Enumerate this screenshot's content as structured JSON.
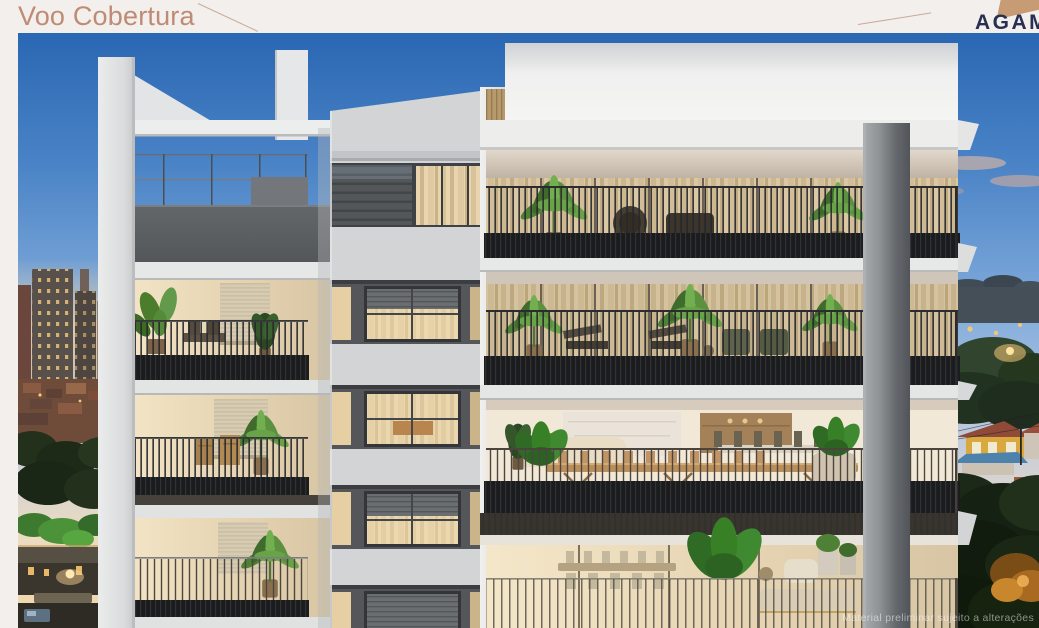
{
  "page": {
    "background_color": "#f2efec"
  },
  "header": {
    "title": "Voo Cobertura",
    "title_color": "#bf8b74",
    "logo_text": "AGAM",
    "logo_text_color": "#273052",
    "logo_mark_color": "#c79b73"
  },
  "render": {
    "watermark": "Material preliminar sujeito a alterações",
    "description": "Dusk rendering of a modern residential tower with planted balconies, city skyline at left and suburban houses at right",
    "palette": {
      "sky_top": "#2a67b3",
      "sky_horizon": "#f2d8ab",
      "facade_white": "#ededec",
      "facade_gray_panel": "#54565a",
      "railing_dark": "#26272b",
      "interior_warm": "#e8d5b0",
      "foliage_green": "#5c9140",
      "concrete_column": "#8e9294",
      "city_roof": "#6f4b39"
    }
  }
}
